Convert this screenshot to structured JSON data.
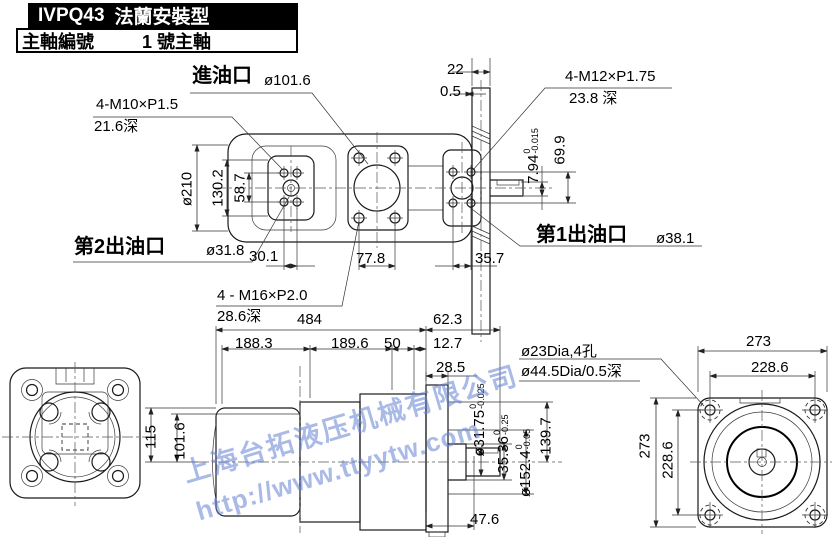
{
  "title_block": {
    "model": "IVPQ43",
    "mount_type": "法蘭安裝型",
    "row_label": "主軸編號",
    "row_value": "1 號主軸"
  },
  "watermark": {
    "line1": "上海台拓液压机械有限公司",
    "line2": "http://www.ttyytw.com",
    "color": "rgba(100,130,210,0.55)"
  },
  "top_view": {
    "ports": {
      "inlet_label": "進油口",
      "inlet_dia": "ø101.6",
      "outlet2_label": "第2出油口",
      "outlet2_dia": "ø31.8",
      "outlet1_label": "第1出油口",
      "outlet1_dia": "ø38.1"
    },
    "thread_notes": {
      "m10": "4-M10×P1.5",
      "m10_depth": "21.6深",
      "m12": "4-M12×P1.75",
      "m12_depth": "23.8 深",
      "m16": "4 - M16×P2.0",
      "m16_depth": "28.6深"
    },
    "dims": {
      "flange_thickness": "22",
      "flange_offset": "0.5",
      "body_dia": "ø210",
      "pad_width": "130.2",
      "outlet2_bolt_span_v": "58.7",
      "outlet2_bolt_span": "30.1",
      "inlet_bolt_span": "77.8",
      "outlet1_bolt_span": "35.7",
      "outlet1_bolt_span_v": "69.9",
      "key_height": {
        "value": "7.94",
        "tol_upper": "0",
        "tol_lower": "-0.015"
      }
    }
  },
  "side_view": {
    "dims": {
      "overall_length": "484",
      "shaft_extension": "62.3",
      "seg1": "188.3",
      "seg2": "189.6",
      "seg3": "50",
      "seg4": "12.7",
      "flange_thickness": "28.5",
      "body_height": "115",
      "body_dia": "101.6",
      "flange_height": "139.7",
      "shaft_length": "47.6",
      "shaft_dia": {
        "value": "ø31.75",
        "tol_upper": "0",
        "tol_lower": "-0.025"
      },
      "key_span": {
        "value": "35.36",
        "tol_upper": "0",
        "tol_lower": "-0.25"
      },
      "pilot_dia": {
        "value": "ø152.4",
        "tol_upper": "0",
        "tol_lower": "-0.05"
      }
    },
    "hole_note": {
      "line1": "ø23Dia,4孔",
      "line2": "ø44.5Dia/0.5深"
    }
  },
  "front_view": {
    "dims": {
      "width": "273",
      "bolt_span_h": "228.6",
      "height": "273",
      "bolt_span_v": "228.6"
    }
  }
}
